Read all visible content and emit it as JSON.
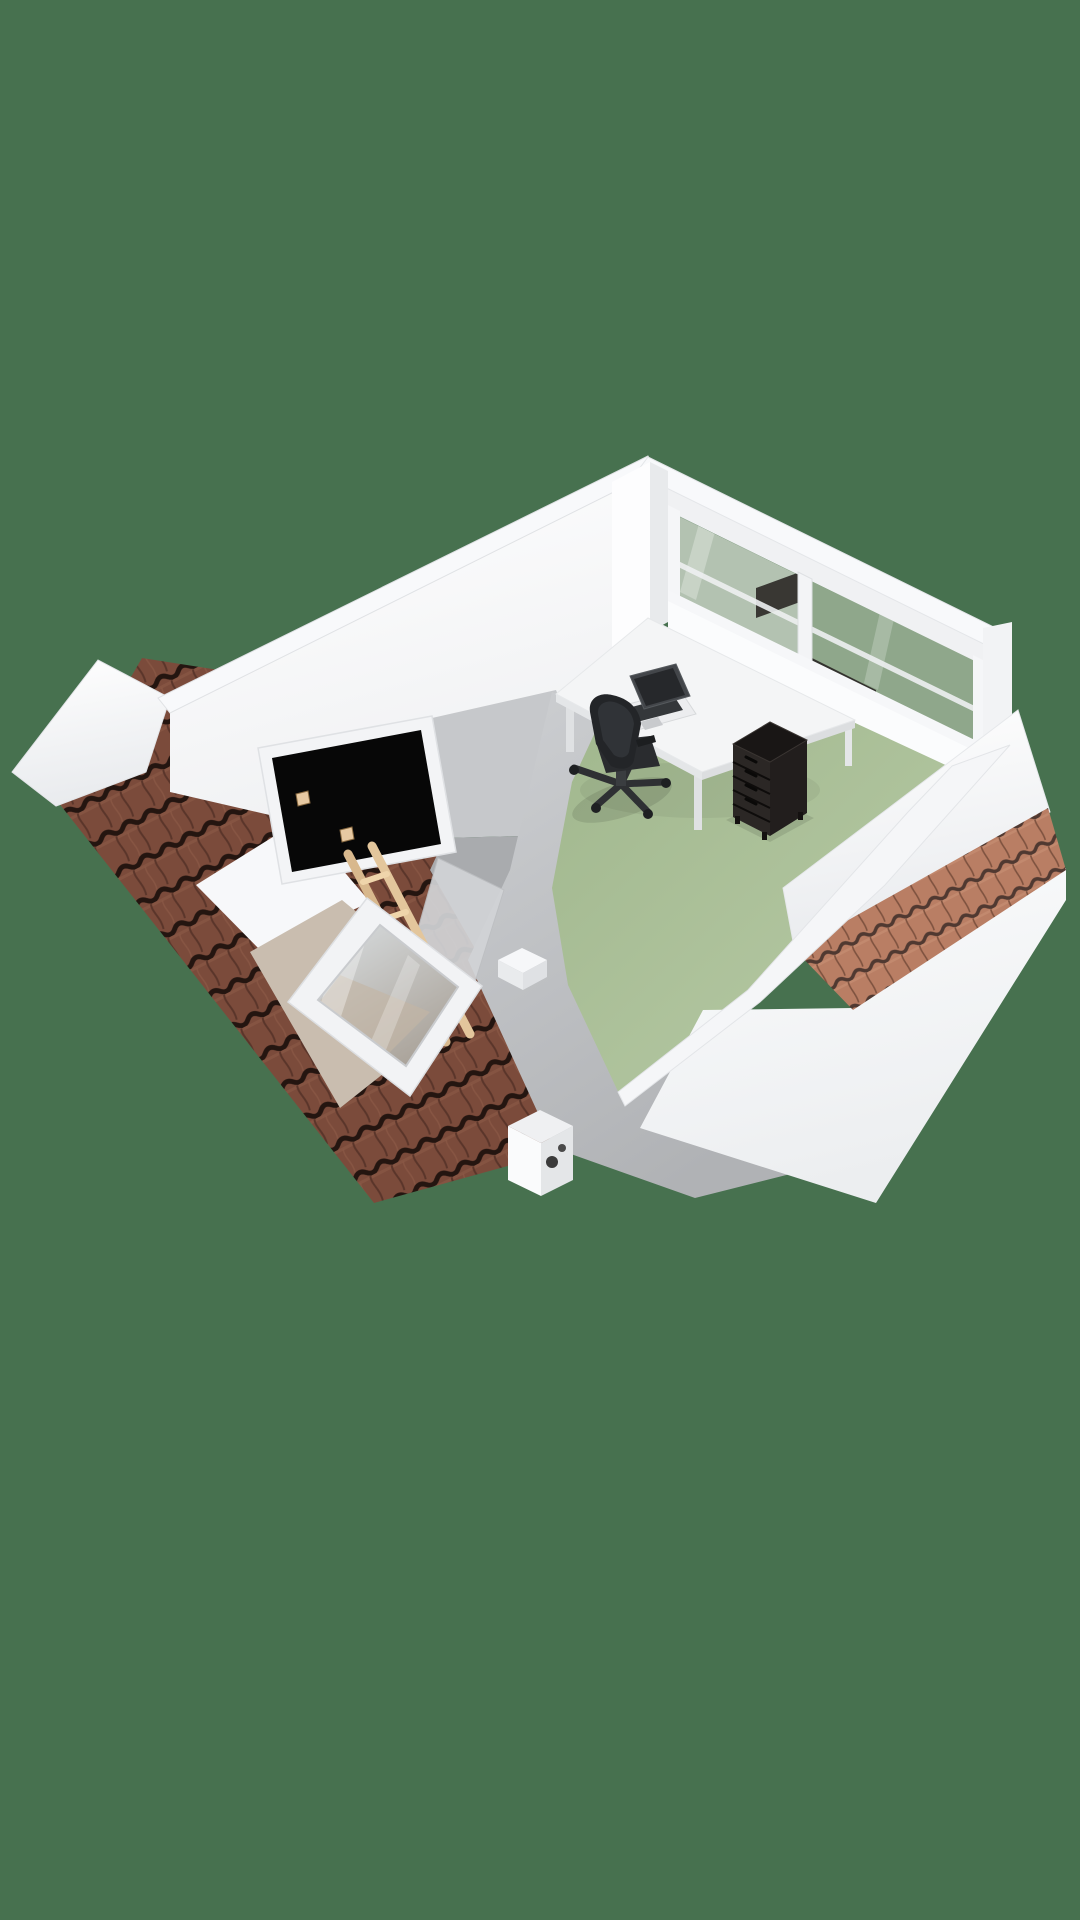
{
  "scene": {
    "kind": "3d-floorplan-render",
    "view": "isometric-overhead",
    "colors": {
      "background": "#47714F",
      "floor": "#A9BF97",
      "wall_white": "#FDFEFE",
      "wall_top_band": "#F8F9FB",
      "wall_shadow_gray": "#C6C8CB",
      "shaft_gray_dark": "#A9ABAE",
      "roof_tiles": "#7B4B3B",
      "roof_tile_gap": "#241510",
      "dormer_roof_tiles": "#B97E64",
      "stair_opening": "#070707",
      "stair_post_wood": "#E7C9A2",
      "ladder_wood": "#D8B88D",
      "ladder_rung": "#EFD5AB",
      "window_glass": "#8FA78B",
      "window_frame": "#F3F4F6",
      "skylight_recess_beige": "#C9BDAF",
      "skylight_frame": "#F2F3F5",
      "desk_top": "#F4F5F6",
      "laptop_screen": "#26282B",
      "laptop_base": "#ECEDEF",
      "chair_black": "#2A2C2F",
      "drawer_unit_front": "#2B2725",
      "drawer_unit_top": "#191615",
      "boiler_white": "#FAFBFC",
      "glass_dark_reflection": "#2B2826"
    },
    "rooms": [
      {
        "name": "attic-room",
        "floor_finish": "sage-green"
      },
      {
        "name": "stair-landing",
        "floor_finish": "white"
      }
    ],
    "features": [
      "pitched-tiled-roof",
      "left-gable",
      "right-dormer-roof",
      "skylight-window",
      "stair-opening-with-wooden-ladder",
      "glazed-window-wall",
      "knee-walls"
    ],
    "furniture": [
      "desk",
      "laptop",
      "office-chair",
      "drawer-unit",
      "boiler-unit",
      "wall-ledge"
    ]
  }
}
